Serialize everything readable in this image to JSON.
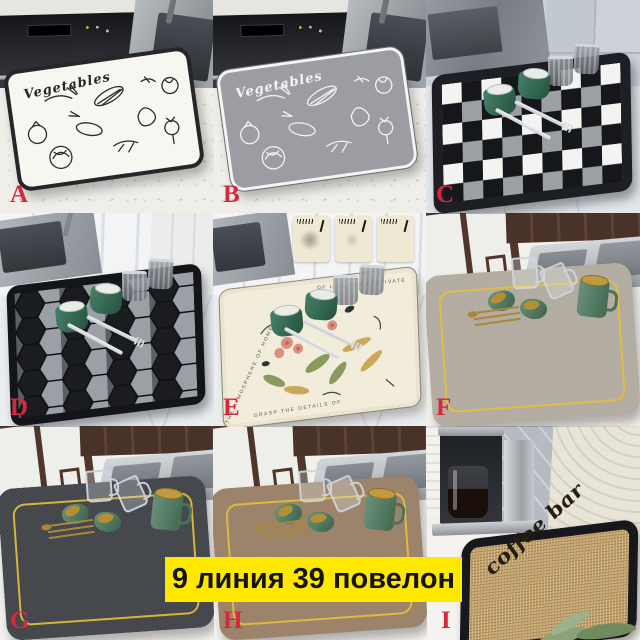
{
  "banner": {
    "text": "9 линия 39 повелон",
    "bg_color": "#ffe800",
    "text_color": "#141414"
  },
  "label_color": "#d5293d",
  "cells": [
    {
      "letter": "A",
      "photo": "white dish-drying mat with black vegetable line art, black oven and sink behind",
      "mat_text": "Vegetables",
      "mat_color": "#f8f6f0",
      "accent": "#26262a"
    },
    {
      "letter": "B",
      "photo": "gray dish-drying mat with white vegetable line art, black oven and sink behind",
      "mat_text": "Vegetables",
      "mat_color": "#9b9da2",
      "accent": "#f4f4f2"
    },
    {
      "letter": "C",
      "photo": "black-white-gray checkerboard drying mat with green cups, glasses and cutlery",
      "mat_color": "#1d1f24"
    },
    {
      "letter": "D",
      "photo": "black, gray and white honeycomb drying mat with green cups, glasses and cutlery",
      "mat_color": "#141518"
    },
    {
      "letter": "E",
      "photo": "cream floral drying mat with lettered border, green cups and absorption demo insets",
      "border_text_top": "OF LIFE AND CULTIVATE",
      "border_text_side": "THE ATMOSPHERE OF HOME",
      "border_text_bottom": "GRASP THE DETAILS OF",
      "mat_color": "#f2ecda"
    },
    {
      "letter": "F",
      "photo": "greige drying mat with thin yellow border line, glass mugs and green mugs by a lattice window",
      "mat_color": "#b2aba0",
      "line_color": "#e2bf3a"
    },
    {
      "letter": "G",
      "photo": "charcoal drying mat with thin yellow border line, glass mugs and green mugs by a lattice window",
      "mat_color": "#42454a",
      "line_color": "#e2bf3a"
    },
    {
      "letter": "H",
      "photo": "brown drying mat with thin yellow border line, glass mugs and green mugs by a lattice window",
      "mat_color": "#9a8168",
      "line_color": "#e2bf3a"
    },
    {
      "letter": "I",
      "photo": "burlap coffee bar drying mat with black rim beside a drip coffee maker",
      "mat_text": "coffee bar",
      "mat_color": "#c2a069"
    }
  ]
}
